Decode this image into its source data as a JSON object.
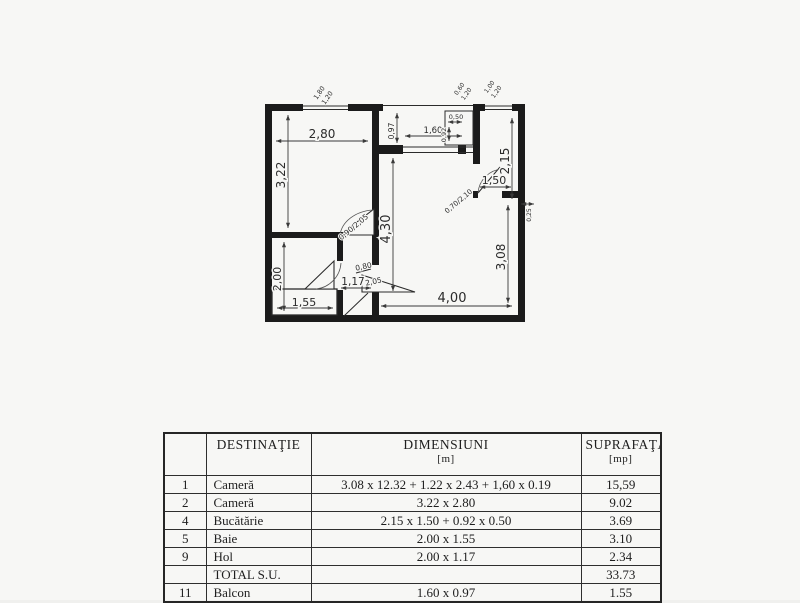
{
  "colors": {
    "ink": "#1b1b1b",
    "paper": "#f7f7f5"
  },
  "plan": {
    "dims": {
      "room2_width": "2,80",
      "room2_height": "3,22",
      "bath_height": "2,00",
      "bath_width": "1,55",
      "hall_width": "1,17",
      "hall_door_width": "0,80",
      "hall_door_height": "2,05",
      "room_door": "0,90/2,05",
      "hall_length": "4,30",
      "room1_width": "4,00",
      "room1_height": "3,08",
      "kitchen_height": "2,15",
      "kitchen_width": "1,50",
      "balcony_depth": "0,97",
      "balcony_width": "1,60",
      "nook_width": "0,50",
      "nook_height": "0,92",
      "kitchen_door": "0,70/2,10",
      "wall_mark": "0,25"
    },
    "windows": {
      "left_w": "1,80",
      "left_h": "1,20",
      "mid_w": "0,60",
      "mid_h": "1,20",
      "right_w": "1,00",
      "right_h": "1,20"
    }
  },
  "table": {
    "headers": {
      "no": "",
      "destination": "DESTINAŢIE",
      "dimensions": "DIMENSIUNI",
      "dimensions_unit": "[m]",
      "area": "SUPRAFAŢA",
      "area_unit": "[mp]"
    },
    "rows": [
      {
        "no": "1",
        "destination": "Cameră",
        "dimensions": "3.08 x 12.32 + 1.22 x 2.43 + 1,60 x 0.19",
        "area": "15,59"
      },
      {
        "no": "2",
        "destination": "Cameră",
        "dimensions": "3.22 x 2.80",
        "area": "9.02"
      },
      {
        "no": "4",
        "destination": "Bucătărie",
        "dimensions": "2.15 x 1.50 + 0.92 x 0.50",
        "area": "3.69"
      },
      {
        "no": "5",
        "destination": "Baie",
        "dimensions": "2.00 x 1.55",
        "area": "3.10"
      },
      {
        "no": "9",
        "destination": "Hol",
        "dimensions": "2.00 x 1.17",
        "area": "2.34"
      },
      {
        "no": "",
        "destination": "TOTAL S.U.",
        "dimensions": "",
        "area": "33.73"
      },
      {
        "no": "11",
        "destination": "Balcon",
        "dimensions": "1.60 x 0.97",
        "area": "1.55"
      }
    ]
  }
}
